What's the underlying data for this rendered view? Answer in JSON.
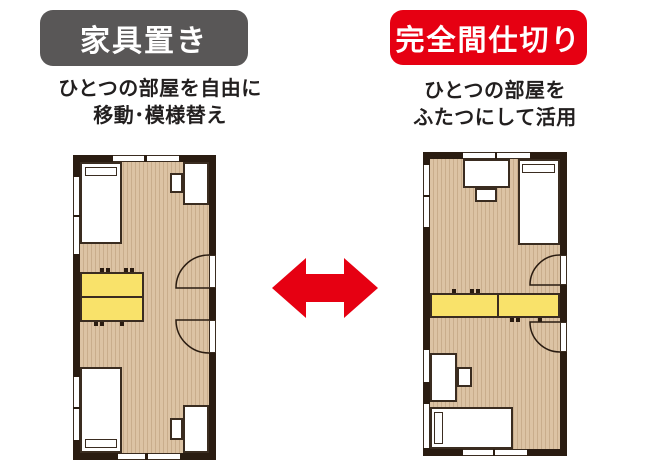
{
  "left_panel": {
    "badge": {
      "label": "家具置き",
      "bg": "#595757",
      "text_color": "#ffffff"
    },
    "subtitle": {
      "line1": "ひとつの部屋を自由に",
      "line2": "移動･模様替え"
    },
    "floorplan": {
      "wall_color": "#2a1c11",
      "floor_color": "#dcc3a4",
      "floor_stripe_color": "#c9ad8c",
      "furniture_fill": "#ffffff",
      "movable_table_color": "#f9e26a",
      "furniture": [
        "bed-top-left",
        "desk-with-chair-top-right",
        "movable-double-table-left",
        "bed-bottom-left",
        "desk-with-chair-bottom-right"
      ],
      "doors": 2,
      "windows": 8
    }
  },
  "right_panel": {
    "badge": {
      "label": "完全間仕切り",
      "bg": "#e60012",
      "text_color": "#ffffff"
    },
    "subtitle": {
      "line1": "ひとつの部屋を",
      "line2": "ふたつにして活用"
    },
    "floorplan": {
      "wall_color": "#2a1c11",
      "floor_color": "#dcc3a4",
      "floor_stripe_color": "#c9ad8c",
      "furniture_fill": "#ffffff",
      "partition_color": "#f9e26a",
      "furniture": [
        "desk-with-chair-top-center",
        "bed-top-right",
        "full-width-partition-shelf",
        "desk-with-chair-bottom-left",
        "bed-bottom-left"
      ],
      "doors": 2,
      "windows": 8
    }
  },
  "arrow": {
    "shape": "double-headed-horizontal",
    "color": "#e60012"
  }
}
